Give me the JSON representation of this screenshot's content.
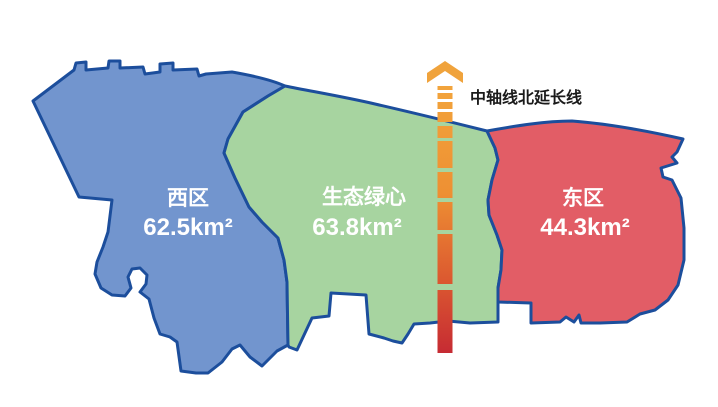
{
  "map": {
    "background": "#FFFFFF",
    "border_color": "#1C4E9C",
    "label_color": "#FFFFFF",
    "regions": {
      "west": {
        "name": "西区",
        "area": "62.5km²",
        "fill": "#7295CE"
      },
      "center": {
        "name": "生态绿心",
        "area": "63.8km²",
        "fill": "#A7D4A0"
      },
      "east": {
        "name": "东区",
        "area": "44.3km²",
        "fill": "#E25D66"
      }
    },
    "axis": {
      "label": "中轴线北延长线",
      "label_color": "#1A1A1A",
      "arrow_color": "#F0A33C",
      "gradient": {
        "top": "#F2A43C",
        "upper_mid": "#EE9033",
        "lower_mid": "#DC5A30",
        "bottom": "#C62B33"
      }
    }
  }
}
